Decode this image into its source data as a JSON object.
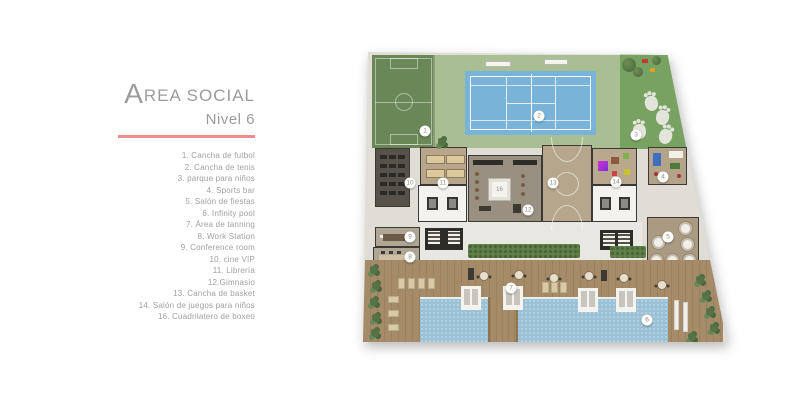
{
  "title": {
    "initial": "A",
    "rest": "REA SOCIAL",
    "subtitle": "Nivel 6"
  },
  "colors": {
    "accent": "#ec8e8c",
    "text_gray": "#9e9e9e",
    "soccer_green": "#6a8757",
    "lawn_green": "#a9be92",
    "park_green": "#78a262",
    "tennis_blue": "#79b3d8",
    "pool_blue": "#9ac1d6",
    "deck_wood": "#a58b68"
  },
  "legend": {
    "items": [
      "1. Cancha de futbol",
      "2. Cancha de tenis",
      "3. parque para niños",
      "4. Sports bar",
      "5. Salón de fiestas",
      "6. Infinity pool",
      "7. Área de tanning",
      "8. Work Station",
      "9. Conference room",
      "10. cine VIP",
      "11. Librería",
      "12.Gimnasio",
      "13. Cancha de basket",
      "14. Salón de juegos para niños",
      "16. Cuadrilatero de boxeo"
    ]
  },
  "plan": {
    "boxing_ring_label": "16",
    "markers": [
      {
        "id": "1",
        "x": 67,
        "y": 93
      },
      {
        "id": "2",
        "x": 181,
        "y": 78
      },
      {
        "id": "3",
        "x": 278,
        "y": 97
      },
      {
        "id": "4",
        "x": 305,
        "y": 139
      },
      {
        "id": "5",
        "x": 310,
        "y": 199
      },
      {
        "id": "6",
        "x": 289,
        "y": 282
      },
      {
        "id": "7",
        "x": 153,
        "y": 250
      },
      {
        "id": "8",
        "x": 52,
        "y": 219
      },
      {
        "id": "9",
        "x": 52,
        "y": 199
      },
      {
        "id": "10",
        "x": 52,
        "y": 145
      },
      {
        "id": "11",
        "x": 85,
        "y": 145
      },
      {
        "id": "12",
        "x": 170,
        "y": 172
      },
      {
        "id": "13",
        "x": 195,
        "y": 145
      },
      {
        "id": "14",
        "x": 258,
        "y": 144
      }
    ]
  }
}
